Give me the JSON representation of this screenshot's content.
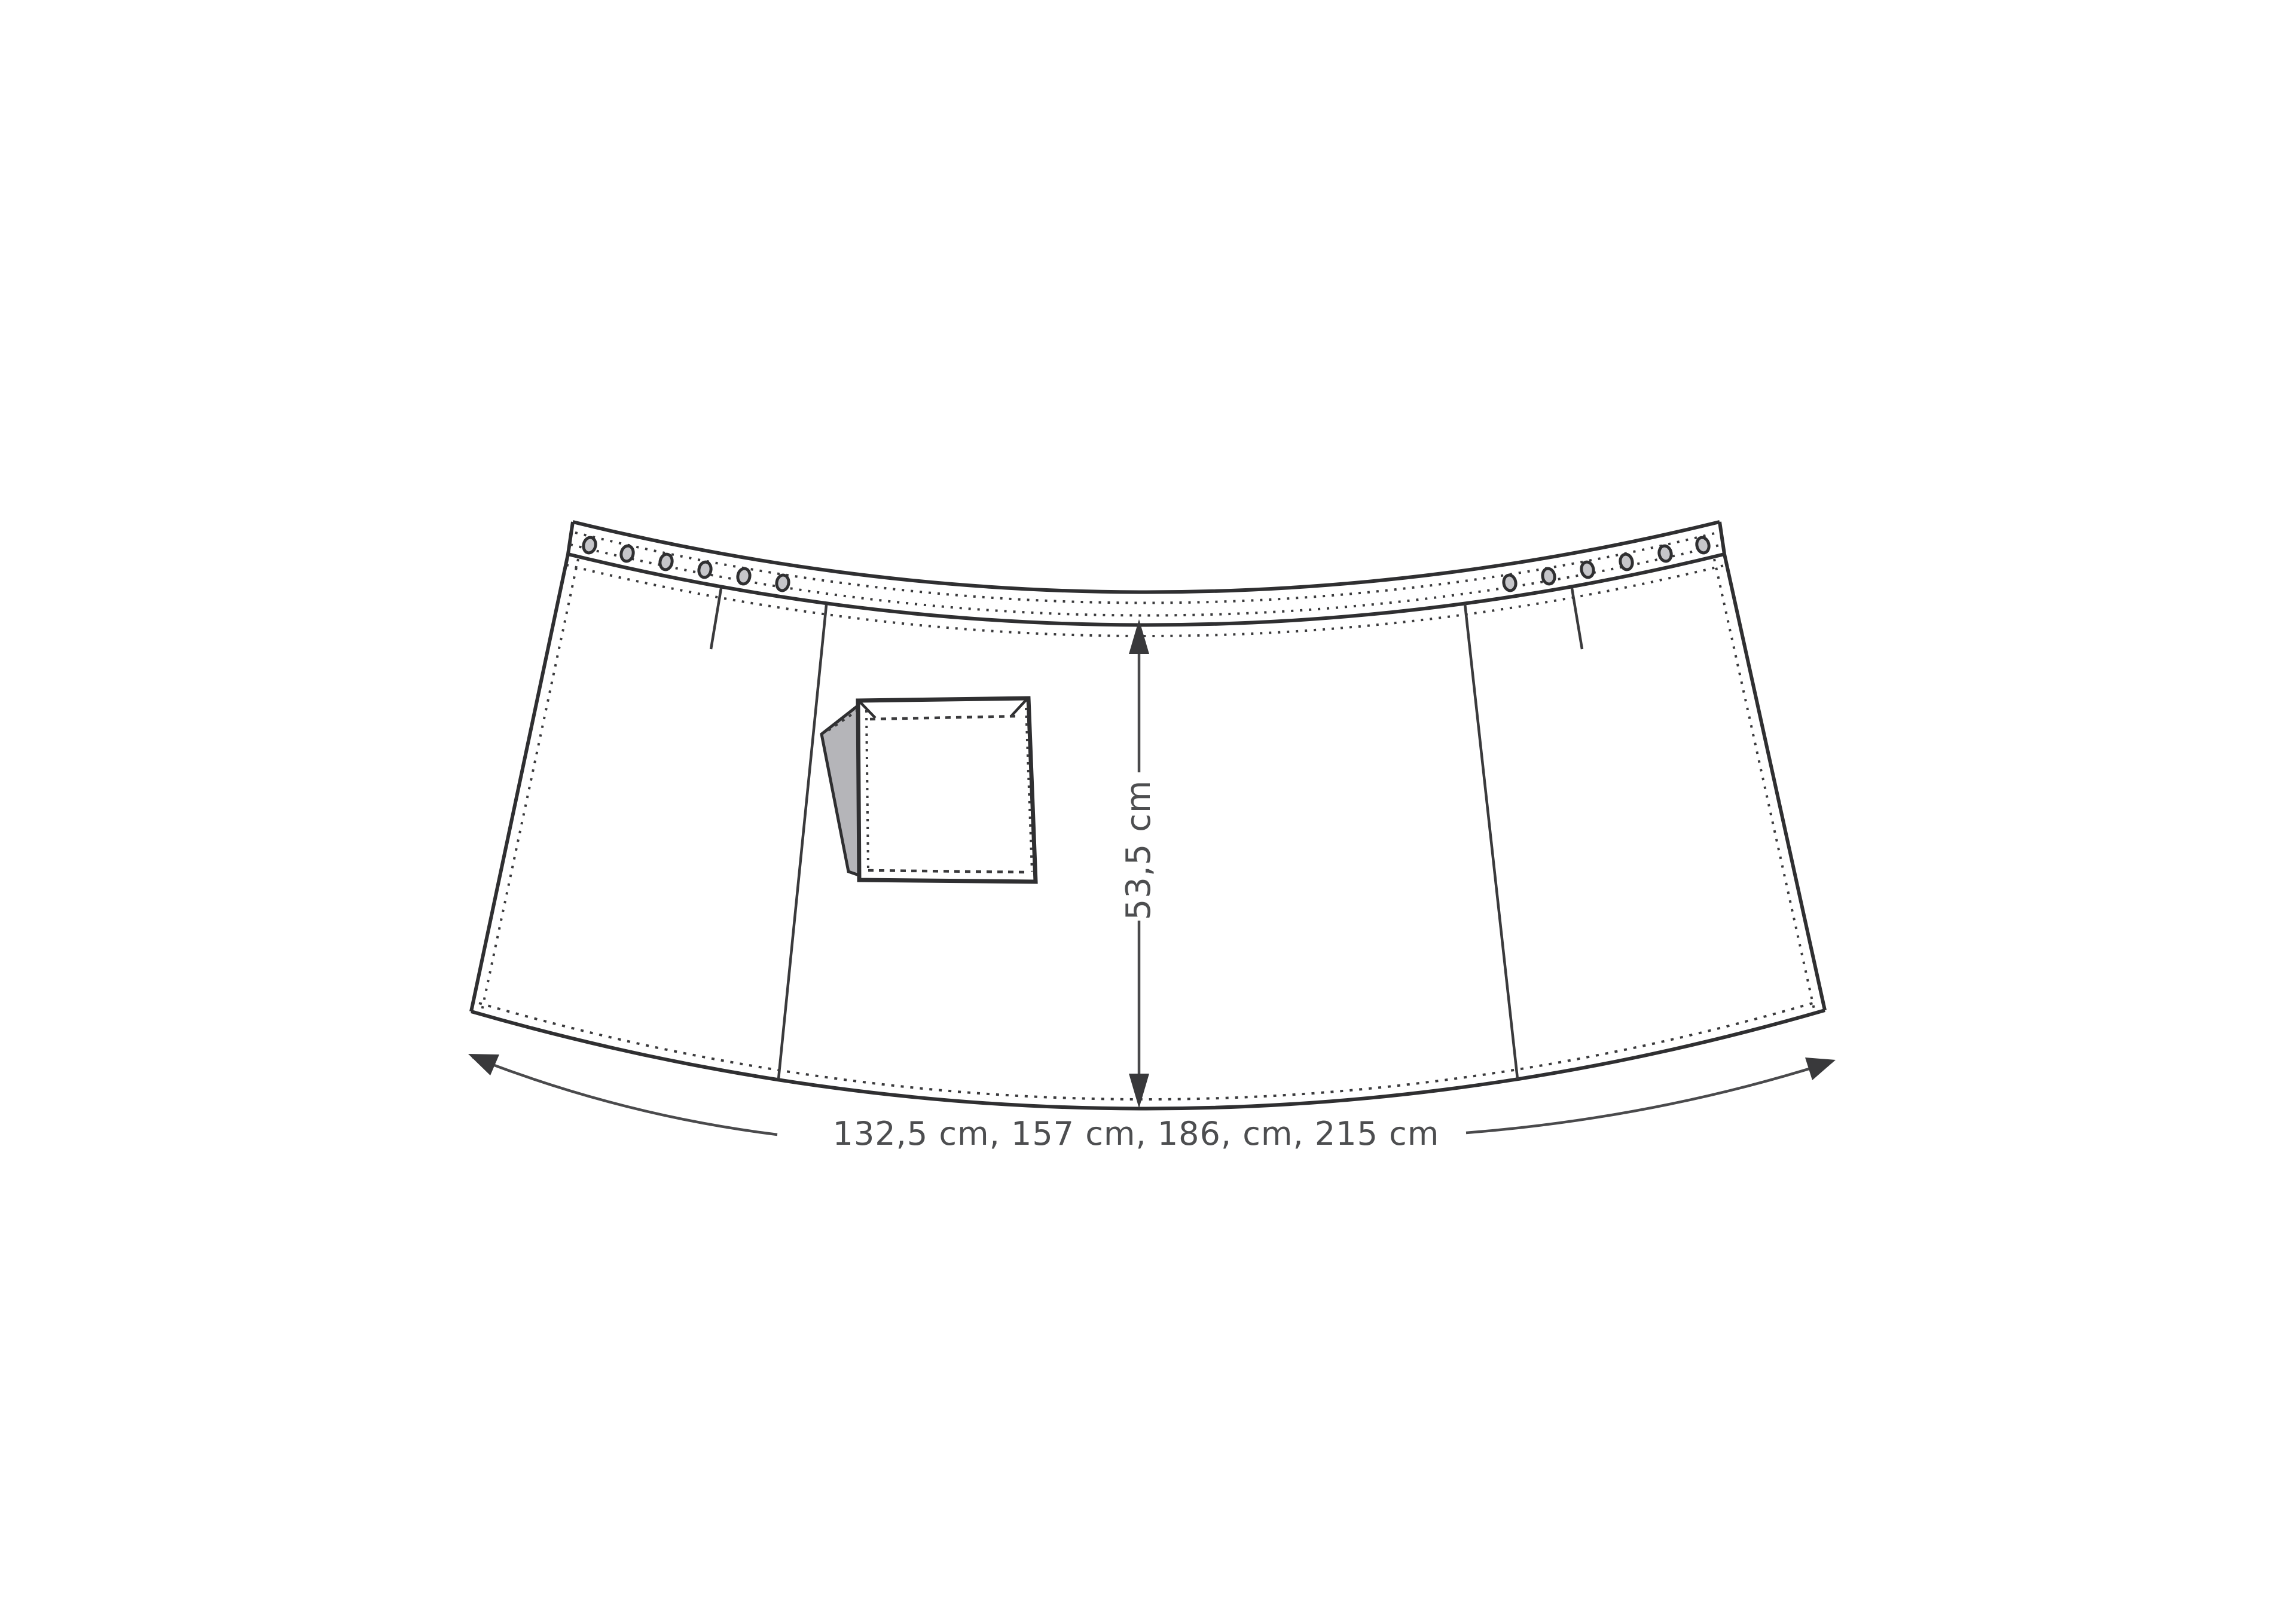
{
  "page": {
    "background": "#ffffff"
  },
  "diagram": {
    "type": "sewing-pattern-technical-drawing",
    "subject": "half apron front pattern with waistband, eyelets, three panels and patch pocket with folded flap",
    "ink_color": "#2f2f31",
    "label_color": "#4d4e50",
    "flap_fill": "#b5b5b9",
    "eyelet_count": 12,
    "labels": {
      "height": "53,5 cm",
      "width": "132,5 cm, 157 cm, 186, cm, 215 cm"
    },
    "measurements": {
      "height_cm": 53.5,
      "width_options_cm": [
        132.5,
        157,
        186,
        215
      ]
    }
  }
}
